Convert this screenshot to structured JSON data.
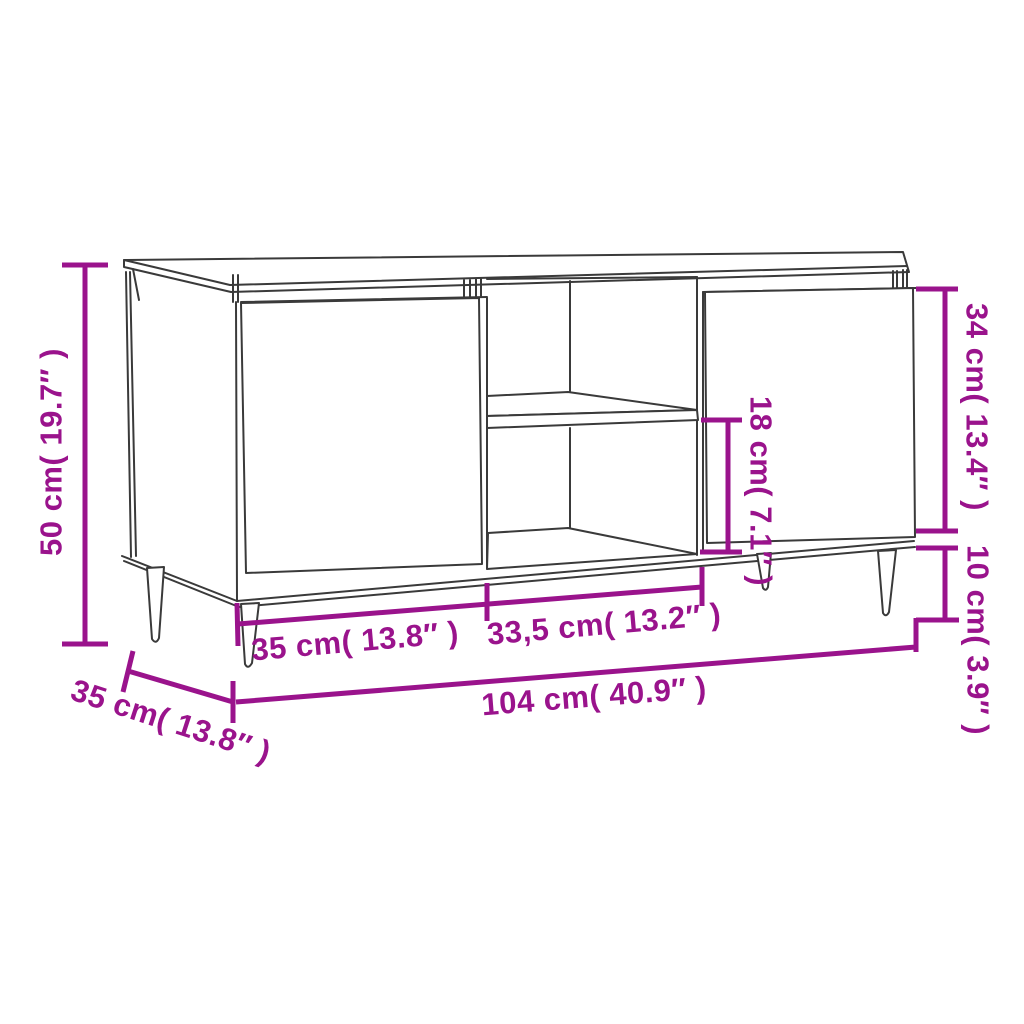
{
  "diagram": {
    "background_color": "#ffffff",
    "outline_color": "#3a3a3a",
    "dimension_color": "#9A138C",
    "labels": {
      "height": "50 cm( 19.7″ )",
      "depth": "35 cm( 13.8″ )",
      "left_door_width": "35 cm( 13.8″ )",
      "middle_section_width": "33,5 cm( 13.2″ )",
      "total_width": "104 cm( 40.9″ )",
      "shelf_opening_height": "18 cm( 7.1″ )",
      "door_panel_height": "34 cm( 13.4″ )",
      "leg_height": "10 cm( 3.9″ )"
    }
  }
}
